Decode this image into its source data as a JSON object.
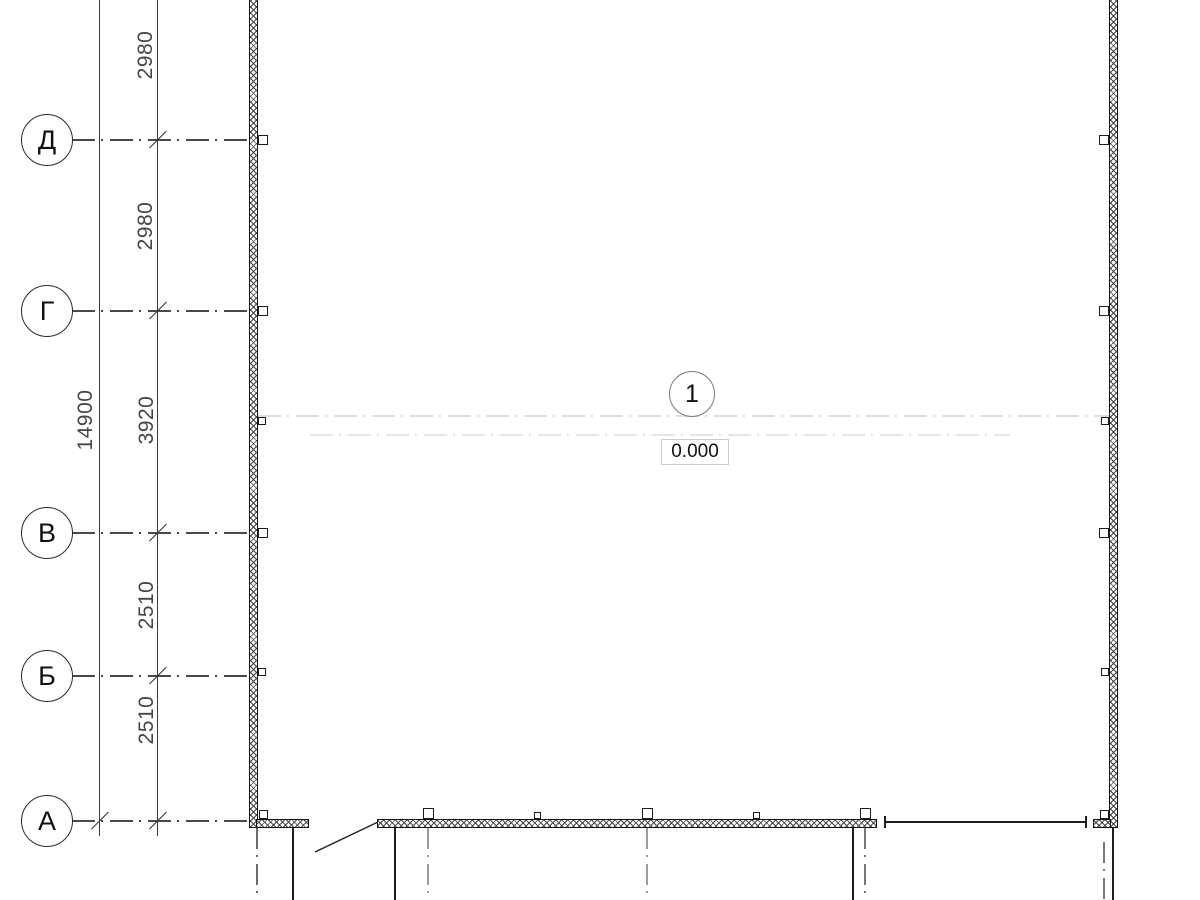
{
  "axes": [
    {
      "label": "Д"
    },
    {
      "label": "Г"
    },
    {
      "label": "В"
    },
    {
      "label": "Б"
    },
    {
      "label": "А"
    }
  ],
  "dimensions": {
    "overall": "14900",
    "spans": [
      "2980",
      "2980",
      "3920",
      "2510",
      "2510"
    ]
  },
  "room": {
    "tag": "1",
    "level": "0.000"
  },
  "colors": {
    "wall_line": "#141414",
    "axis_line": "#4a4a4a",
    "faint_line": "#dedede",
    "background": "#ffffff"
  }
}
